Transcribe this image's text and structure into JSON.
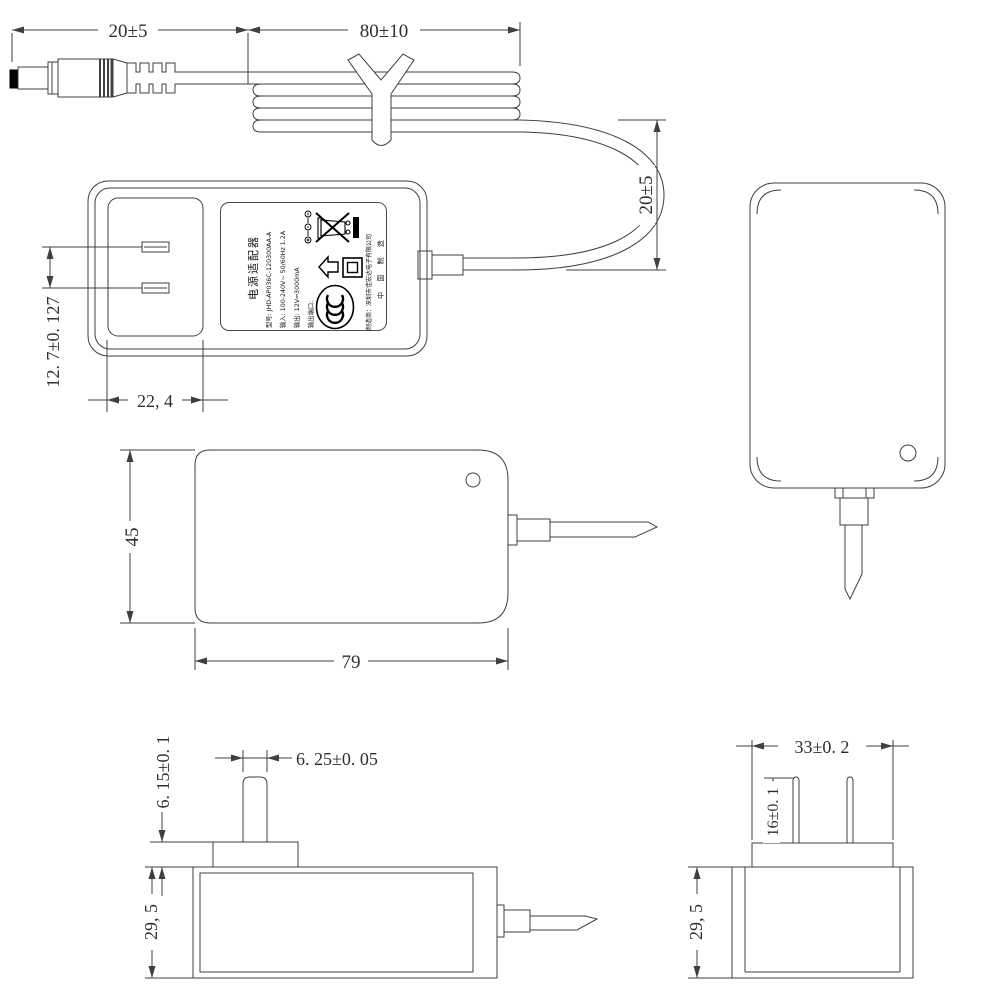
{
  "drawing": {
    "dimensions": {
      "cable_connector_length": "20±5",
      "cable_coil_length": "80±10",
      "cable_loop_height": "20±5",
      "prong_pitch": "12. 7±0. 127",
      "plug_recess_width": "22, 4",
      "body_height": "45",
      "body_width": "79",
      "pedestal_height": "6. 15±0. 1",
      "prong_width": "6. 25±0. 05",
      "body_thickness_left": "29, 5",
      "pedestal_width": "33±0. 2",
      "prong_length": "16±0. 1",
      "body_thickness_right": "29, 5"
    },
    "label": {
      "title": "电源适配器",
      "model": "型号: JHD-AP036C-120300AA-A",
      "input": "输入: 100-240V~ 50/60Hz 1.2A",
      "output": "输出: 12V⎓3000mA",
      "output_port": "输出端口:",
      "manufacturer": "制造商：深圳市佳宏达电子有限公司",
      "made_in": "中 国 制 造"
    },
    "icons": {
      "weee": "crossed-out-wheelie-bin",
      "weee_bar": "black-bar",
      "indoor_use": "house-outline",
      "class_ii": "double-square",
      "ccc": "china-compulsory-certification",
      "polarity": "center-positive-polarity",
      "dc_symbol": "solid-over-dashed-line"
    },
    "colors": {
      "line": "#3f3f3f",
      "text": "#2e2e2e",
      "black": "#000000"
    }
  }
}
